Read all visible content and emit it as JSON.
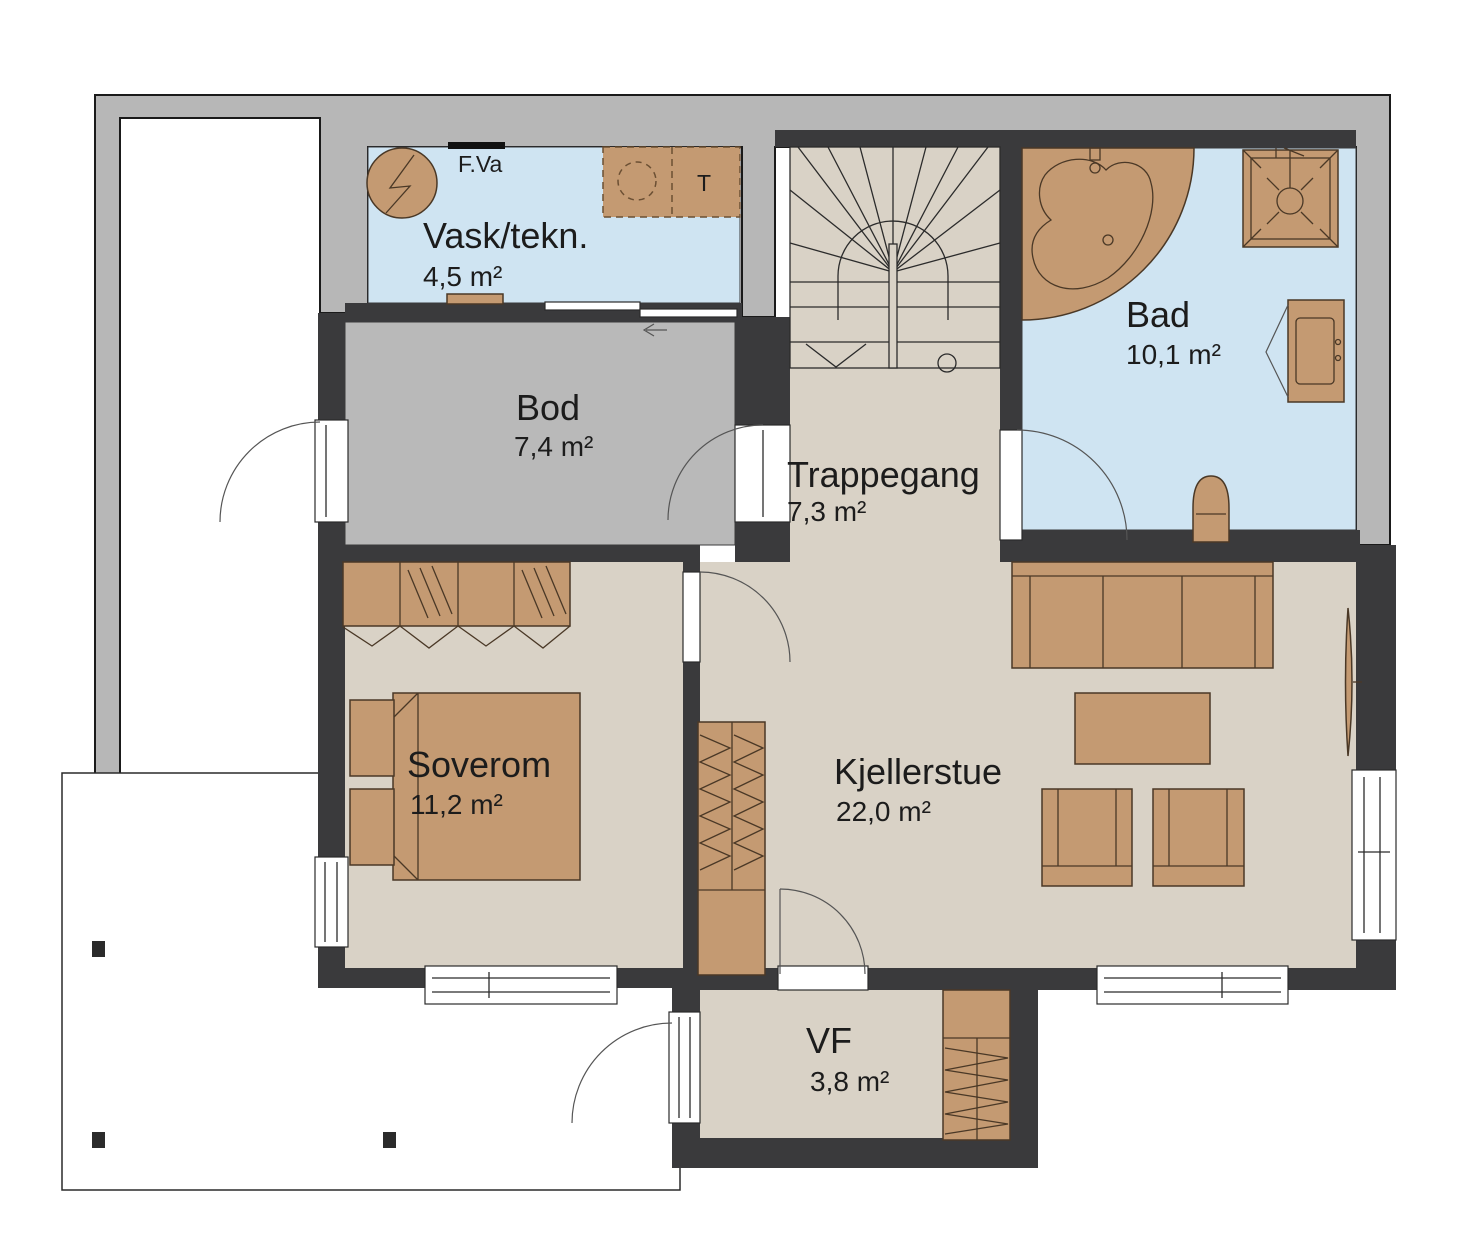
{
  "plan_title": "Basement floor plan",
  "rooms": [
    {
      "name": "Vask/tekn.",
      "area": "4,5 m²"
    },
    {
      "name": "Bod",
      "area": "7,4 m²"
    },
    {
      "name": "Trappegang",
      "area": "7,3 m²"
    },
    {
      "name": "Bad",
      "area": "10,1 m²"
    },
    {
      "name": "Soverom",
      "area": "11,2 m²"
    },
    {
      "name": "Kjellerstue",
      "area": "22,0 m²"
    },
    {
      "name": "VF",
      "area": "3,8 m²"
    }
  ],
  "annotations": {
    "floor_waste": "F.Va",
    "dryer": "T"
  },
  "colors": {
    "terrain_gray": "#b7b7b7",
    "wall_dark": "#3a3a3c",
    "floor_blue": "#cfe4f2",
    "floor_gray": "#b9b9b9",
    "floor_beige": "#d9d2c6",
    "furniture_tan": "#c49a72"
  }
}
